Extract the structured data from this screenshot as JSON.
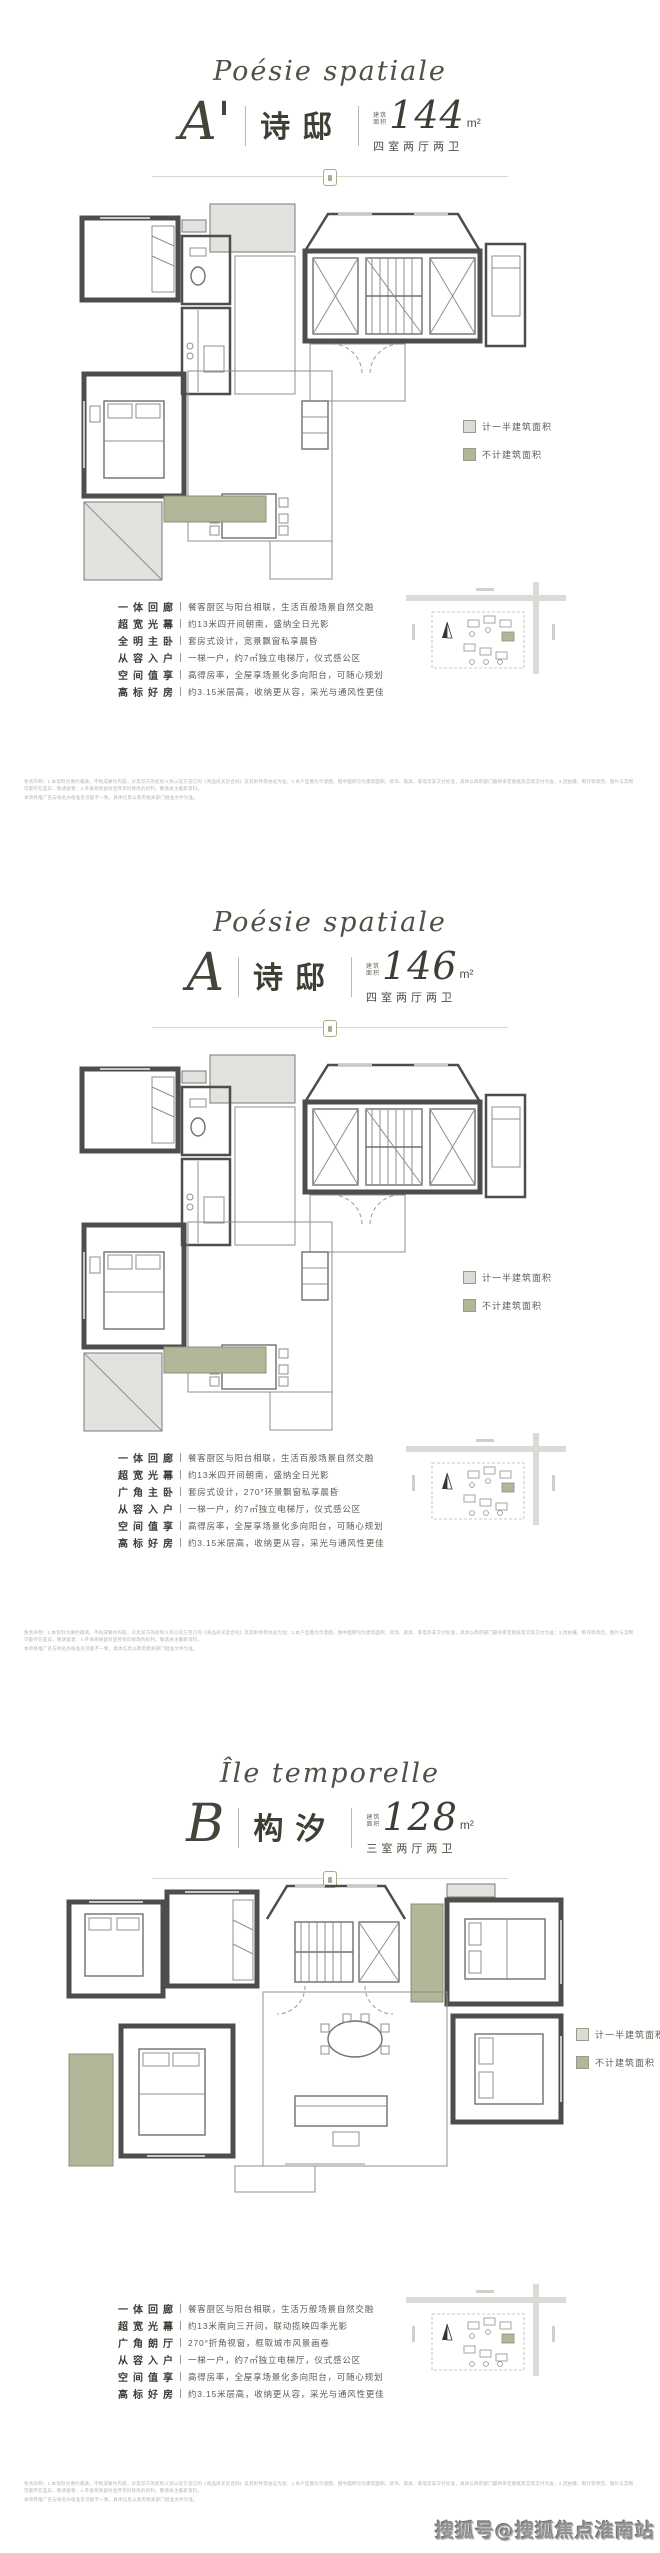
{
  "page": {
    "watermark": "搜狐号@搜狐焦点淮南站"
  },
  "sections": [
    {
      "script_title": "Poésie spatiale",
      "letter": "A'",
      "name": "诗邸",
      "area_label_line1": "建筑",
      "area_label_line2": "面积",
      "area_value": "144",
      "area_unit": "m²",
      "rooms": "四室两厅两卫",
      "legend": [
        {
          "label": "计一半建筑面积",
          "color": "#dcdcd7"
        },
        {
          "label": "不计建筑面积",
          "color": "#b3b698"
        }
      ],
      "features": [
        {
          "label": "一体回廊",
          "desc": "餐客厨区与阳台相联，生活百般场景自然交融"
        },
        {
          "label": "超宽光幕",
          "desc": "约13米四开间朝南，盛纳全日光影"
        },
        {
          "label": "全明主卧",
          "desc": "套房式设计，宽景飘窗私享晨昏"
        },
        {
          "label": "从容入户",
          "desc": "一梯一户，约7㎡独立电梯厅，仪式感公区"
        },
        {
          "label": "空间值享",
          "desc": "高得房率，全屋享场景化多向阳台，可随心规划"
        },
        {
          "label": "高标好房",
          "desc": "约3.15米层高，收纳更从容，采光与通风性更佳"
        }
      ],
      "disclaimer1": "免责声明：1.本资料为要约邀请，不构成要约内容，买卖双方的权利义务以双方签订的《商品房买卖合同》及其附件等协议为准；2.本户型图为示意图，图中面积均为建筑面积，装饰、家具、家电等非交付标准，具体以政府部门最终审定图纸及实际交付为准；3.因拍摄、制作等原因，图片与实物可能存在差异，敬请留意；4.开发商保留对宣传资料修改的权利，敬请关注最新资料。",
      "disclaimer2": "本项目推广名与地名办核准名可能不一致，具体信息以政府相关部门批准文件为准。"
    },
    {
      "script_title": "Poésie spatiale",
      "letter": "A",
      "name": "诗邸",
      "area_label_line1": "建筑",
      "area_label_line2": "面积",
      "area_value": "146",
      "area_unit": "m²",
      "rooms": "四室两厅两卫",
      "legend": [
        {
          "label": "计一半建筑面积",
          "color": "#dcdcd7"
        },
        {
          "label": "不计建筑面积",
          "color": "#b3b698"
        }
      ],
      "features": [
        {
          "label": "一体回廊",
          "desc": "餐客厨区与阳台相联，生活百般场景自然交融"
        },
        {
          "label": "超宽光幕",
          "desc": "约13米四开间朝南，盛纳全日光影"
        },
        {
          "label": "广角主卧",
          "desc": "套房式设计，270°环景飘窗私享晨昏"
        },
        {
          "label": "从容入户",
          "desc": "一梯一户，约7㎡独立电梯厅，仪式感公区"
        },
        {
          "label": "空间值享",
          "desc": "高得房率，全屋享场景化多向阳台，可随心规划"
        },
        {
          "label": "高标好房",
          "desc": "约3.15米层高，收纳更从容，采光与通风性更佳"
        }
      ],
      "disclaimer1": "免责声明：1.本资料为要约邀请，不构成要约内容，买卖双方的权利义务以双方签订的《商品房买卖合同》及其附件等协议为准；2.本户型图为示意图，图中面积均为建筑面积，装饰、家具、家电等非交付标准，具体以政府部门最终审定图纸及实际交付为准；3.因拍摄、制作等原因，图片与实物可能存在差异，敬请留意；4.开发商保留对宣传资料修改的权利，敬请关注最新资料。",
      "disclaimer2": "本项目推广名与地名办核准名可能不一致，具体信息以政府相关部门批准文件为准。"
    },
    {
      "script_title": "Île temporelle",
      "letter": "B",
      "name": "构汐",
      "area_label_line1": "建筑",
      "area_label_line2": "面积",
      "area_value": "128",
      "area_unit": "m²",
      "rooms": "三室两厅两卫",
      "legend": [
        {
          "label": "计一半建筑面积",
          "color": "#dcdcd7"
        },
        {
          "label": "不计建筑面积",
          "color": "#b3b698"
        }
      ],
      "features": [
        {
          "label": "一体回廊",
          "desc": "餐客厨区与阳台相联，生活万般场景自然交融"
        },
        {
          "label": "超宽光幕",
          "desc": "约13米南向三开间，联动揽映四季光影"
        },
        {
          "label": "广角朗厅",
          "desc": "270°折角视窗，框取城市风景画卷"
        },
        {
          "label": "从容入户",
          "desc": "一梯一户，约7㎡独立电梯厅，仪式感公区"
        },
        {
          "label": "空间值享",
          "desc": "高得房率，全屋享场景化多向阳台，可随心规划"
        },
        {
          "label": "高标好房",
          "desc": "约3.15米层高，收纳更从容，采光与通风性更佳"
        }
      ],
      "disclaimer1": "免责声明：1.本资料为要约邀请，不构成要约内容，买卖双方的权利义务以双方签订的《商品房买卖合同》及其附件等协议为准；2.本户型图为示意图，图中面积均为建筑面积，装饰、家具、家电等非交付标准，具体以政府部门最终审定图纸及实际交付为准；3.因拍摄、制作等原因，图片与实物可能存在差异，敬请留意；4.开发商保留对宣传资料修改的权利，敬请关注最新资料。",
      "disclaimer2": "本项目推广名与地名办核准名可能不一致，具体信息以政府相关部门批准文件为准。"
    }
  ]
}
